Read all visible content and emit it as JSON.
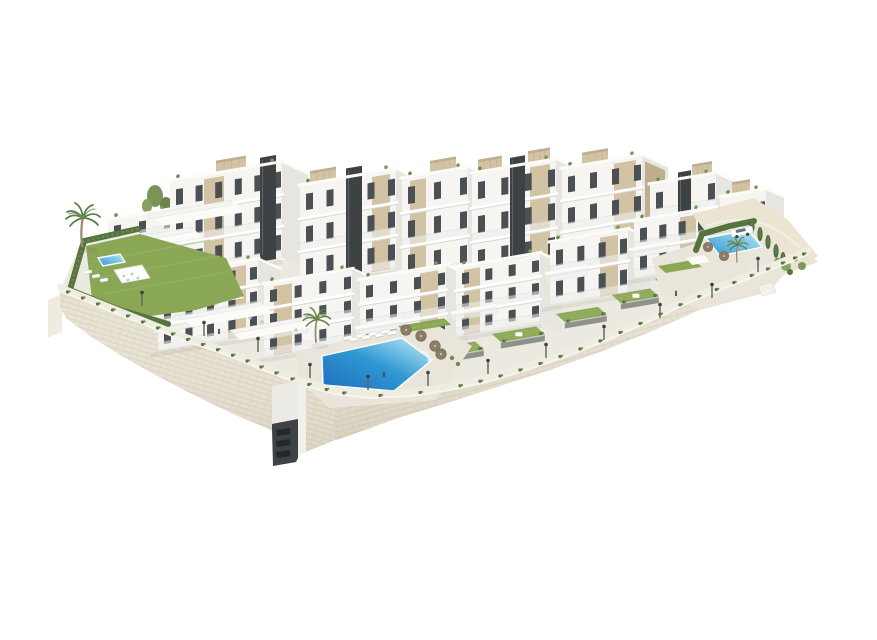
{
  "scene": {
    "type": "architectural-3d-render",
    "subject": "Aerial render of a modern white residential complex on a terraced hillside: stepped apartment blocks with beige accent panels and dark stair cores, private lawned gardens, a large central community pool, a smaller right-hand pool with sun loungers and a parked white car, a left villa garden with its own pool and pergola, palm trees, street lamps along a promenade, and a long curved stone retaining wall below",
    "background": "#ffffff",
    "colors": {
      "background": "#ffffff",
      "building_white": "#f6f5f2",
      "building_side": "#e7e5df",
      "building_parapet": "#fcfbf8",
      "accent_beige": "#d2c3a5",
      "accent_beige_dark": "#bfae8d",
      "dark_core": "#3e4245",
      "window_dark": "#4b5054",
      "window_lite": "#9aa2a7",
      "ground": "#ece9e0",
      "deck": "#e9e5da",
      "lawn_green": "#8aa756",
      "lawn_light": "#9cb769",
      "hedge_green": "#55743f",
      "garden_wall": "#8e918c",
      "pool_deep": "#1d6dbd",
      "pool_mid": "#2f97d3",
      "pool_light": "#8fd0ea",
      "pool_pale": "#c9e9f5",
      "stone_wall": "#e8e2d4",
      "stone_line": "#d9d1bf",
      "terrain_sand": "#ebe4d2",
      "palm_trunk": "#9b8a6d",
      "palm_leaf": "#5d7d45",
      "umbrella_taupe": "#8d7d68",
      "lamp_gray": "#5f625f"
    },
    "features": {
      "pools": [
        "left-villa-pool",
        "central-community-pool",
        "right-community-pool"
      ],
      "building_count": 14,
      "private_gardens": 7,
      "palm_trees": 3,
      "street_lamps": 12,
      "vehicles": [
        "white-car"
      ],
      "other": [
        "stone-retaining-wall",
        "service-tower-in-wall",
        "rooftop-pergolas",
        "sun-loungers",
        "parasols",
        "cypress-row",
        "shrub-cluster"
      ]
    }
  }
}
